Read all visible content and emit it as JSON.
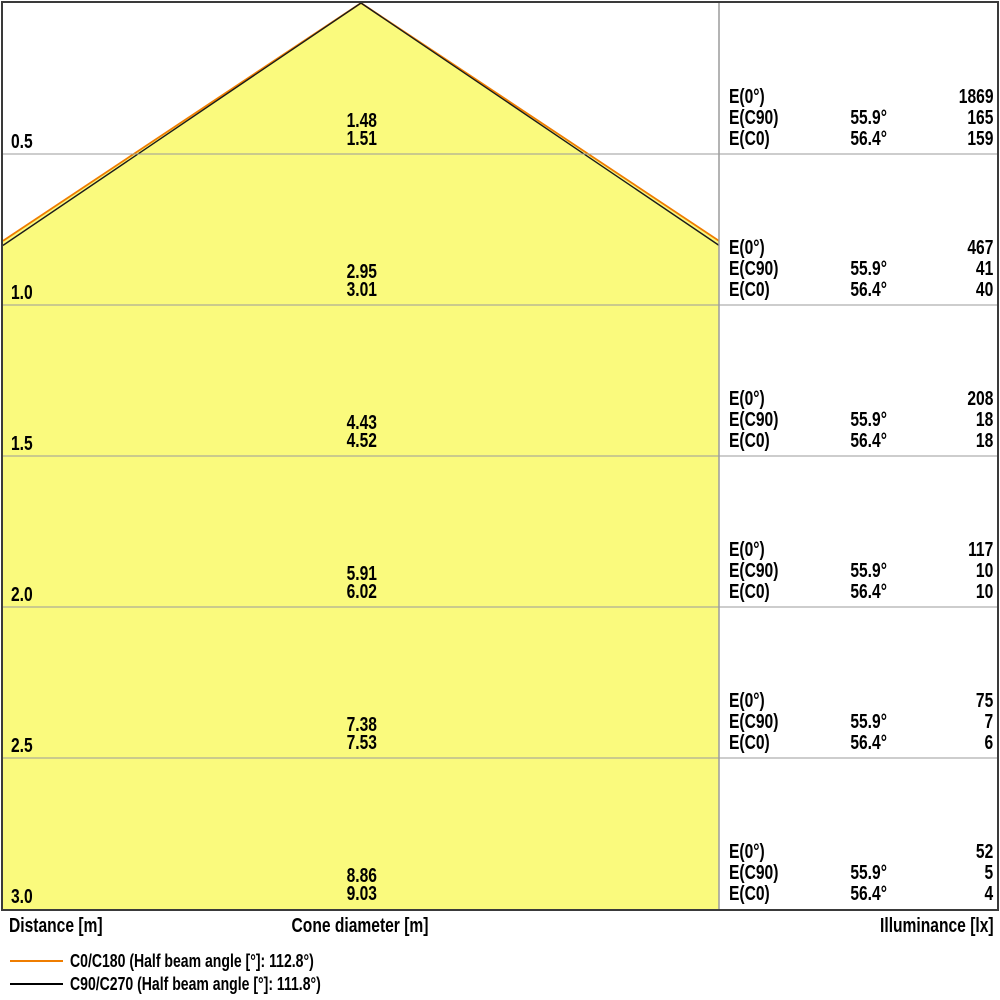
{
  "title": "Light cone diagram",
  "axis": {
    "distance_label": "Distance [m]",
    "cone_diameter_label": "Cone diameter [m]",
    "illuminance_label": "Illuminance [lx]"
  },
  "legend": {
    "c0_label": "C0/C180 (Half beam angle [°]: 112.8°)",
    "c90_label": "C90/C270 (Half beam angle [°]: 111.8°)"
  },
  "colors": {
    "cone_fill": "#FAFA7D",
    "c0_line": "#EF7D00",
    "c90_line": "#1a1a1a",
    "grid_line": "#9B9B9B",
    "frame": "#3A3A3A"
  },
  "rows": [
    {
      "distance": "0.5",
      "cone_c90": "1.48",
      "cone_c0": "1.51",
      "e0_label": "E(0°)",
      "e0": "1869",
      "ec90_label": "E(C90)",
      "ec90_angle": "55.9°",
      "ec90": "165",
      "ec0_label": "E(C0)",
      "ec0_angle": "56.4°",
      "ec0": "159"
    },
    {
      "distance": "1.0",
      "cone_c90": "2.95",
      "cone_c0": "3.01",
      "e0_label": "E(0°)",
      "e0": "467",
      "ec90_label": "E(C90)",
      "ec90_angle": "55.9°",
      "ec90": "41",
      "ec0_label": "E(C0)",
      "ec0_angle": "56.4°",
      "ec0": "40"
    },
    {
      "distance": "1.5",
      "cone_c90": "4.43",
      "cone_c0": "4.52",
      "e0_label": "E(0°)",
      "e0": "208",
      "ec90_label": "E(C90)",
      "ec90_angle": "55.9°",
      "ec90": "18",
      "ec0_label": "E(C0)",
      "ec0_angle": "56.4°",
      "ec0": "18"
    },
    {
      "distance": "2.0",
      "cone_c90": "5.91",
      "cone_c0": "6.02",
      "e0_label": "E(0°)",
      "e0": "117",
      "ec90_label": "E(C90)",
      "ec90_angle": "55.9°",
      "ec90": "10",
      "ec0_label": "E(C0)",
      "ec0_angle": "56.4°",
      "ec0": "10"
    },
    {
      "distance": "2.5",
      "cone_c90": "7.38",
      "cone_c0": "7.53",
      "e0_label": "E(0°)",
      "e0": "75",
      "ec90_label": "E(C90)",
      "ec90_angle": "55.9°",
      "ec90": "7",
      "ec0_label": "E(C0)",
      "ec0_angle": "56.4°",
      "ec0": "6"
    },
    {
      "distance": "3.0",
      "cone_c90": "8.86",
      "cone_c0": "9.03",
      "e0_label": "E(0°)",
      "e0": "52",
      "ec90_label": "E(C90)",
      "ec90_angle": "55.9°",
      "ec90": "5",
      "ec0_label": "E(C0)",
      "ec0_angle": "56.4°",
      "ec0": "4"
    }
  ],
  "chart_data": {
    "type": "table",
    "title": "Light cone diagram (cone diameter and illuminance vs distance)",
    "columns": [
      "Distance [m]",
      "Cone diameter [m]",
      "Illuminance [lx]"
    ],
    "distances_m": [
      0.5,
      1.0,
      1.5,
      2.0,
      2.5,
      3.0
    ],
    "series": [
      {
        "name": "Cone diameter C90/C270 [m]",
        "values": [
          1.48,
          2.95,
          4.43,
          5.91,
          7.38,
          8.86
        ]
      },
      {
        "name": "Cone diameter C0/C180 [m]",
        "values": [
          1.51,
          3.01,
          4.52,
          6.02,
          7.53,
          9.03
        ]
      },
      {
        "name": "E(0°) [lx]",
        "values": [
          1869,
          467,
          208,
          117,
          75,
          52
        ]
      },
      {
        "name": "E(C90) [lx] at 55.9°",
        "values": [
          165,
          41,
          18,
          10,
          7,
          5
        ]
      },
      {
        "name": "E(C0) [lx] at 56.4°",
        "values": [
          159,
          40,
          18,
          10,
          6,
          4
        ]
      }
    ],
    "half_beam_angle_c0_c180_deg": 112.8,
    "half_beam_angle_c90_c270_deg": 111.8,
    "half_angle_c0_deg": 56.4,
    "half_angle_c90_deg": 55.9,
    "legend_entries": [
      "C0/C180 (Half beam angle [°]: 112.8°)",
      "C90/C270 (Half beam angle [°]: 111.8°)"
    ],
    "legend_position": "bottom-left",
    "grid": true,
    "ylim_m": [
      0,
      3.0
    ]
  }
}
